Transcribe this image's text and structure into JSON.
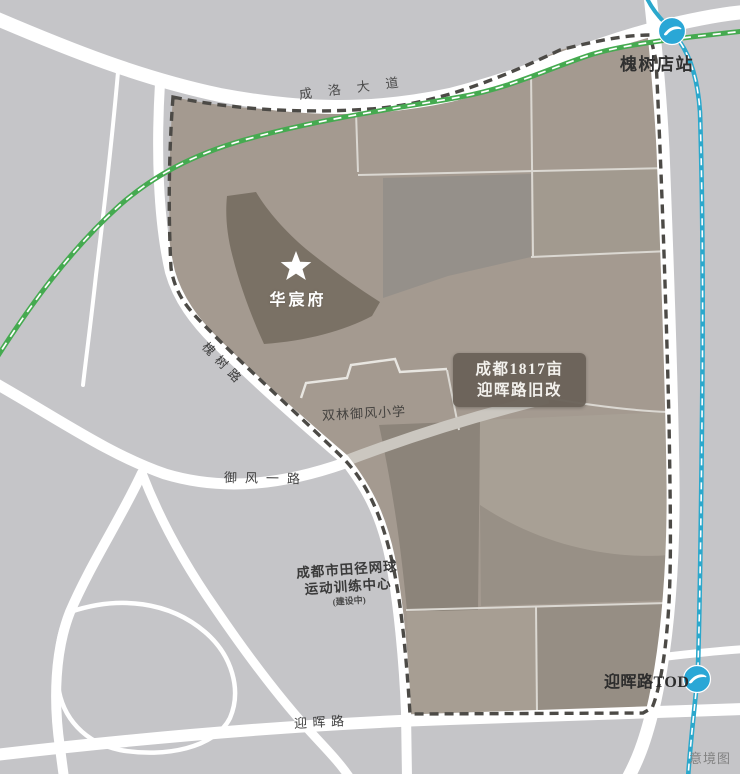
{
  "caption": "意境图",
  "colors": {
    "background": "#c5c5c8",
    "site_fill": "#a49a90",
    "project_parcel": "#7a7165",
    "boundary": "#4c4a46",
    "road": "#ffffff",
    "greenway": "#45aa50",
    "metro_line": "#2ba8cc",
    "metro_badge": "#2aa7d6",
    "label_box_bg": "#6a6258"
  },
  "icons": {
    "project_marker": "star-icon",
    "station_marker": "metro-logo-icon"
  },
  "site": {
    "project_name": "华宸府",
    "label_box": {
      "line1": "成都1817亩",
      "line2": "迎晖路旧改"
    },
    "school": "双林御风小学",
    "sports_center": {
      "line1": "成都市田径网球",
      "line2": "运动训练中心",
      "note": "(建设中)"
    }
  },
  "stations": {
    "huaishudian": "槐树店站",
    "yinghui_tod": "迎晖路TOD"
  },
  "roads": {
    "chengluo": "成洛大道",
    "huaishu": "槐树路",
    "yufeng_yi": "御风一路",
    "yinghui": "迎晖路"
  }
}
